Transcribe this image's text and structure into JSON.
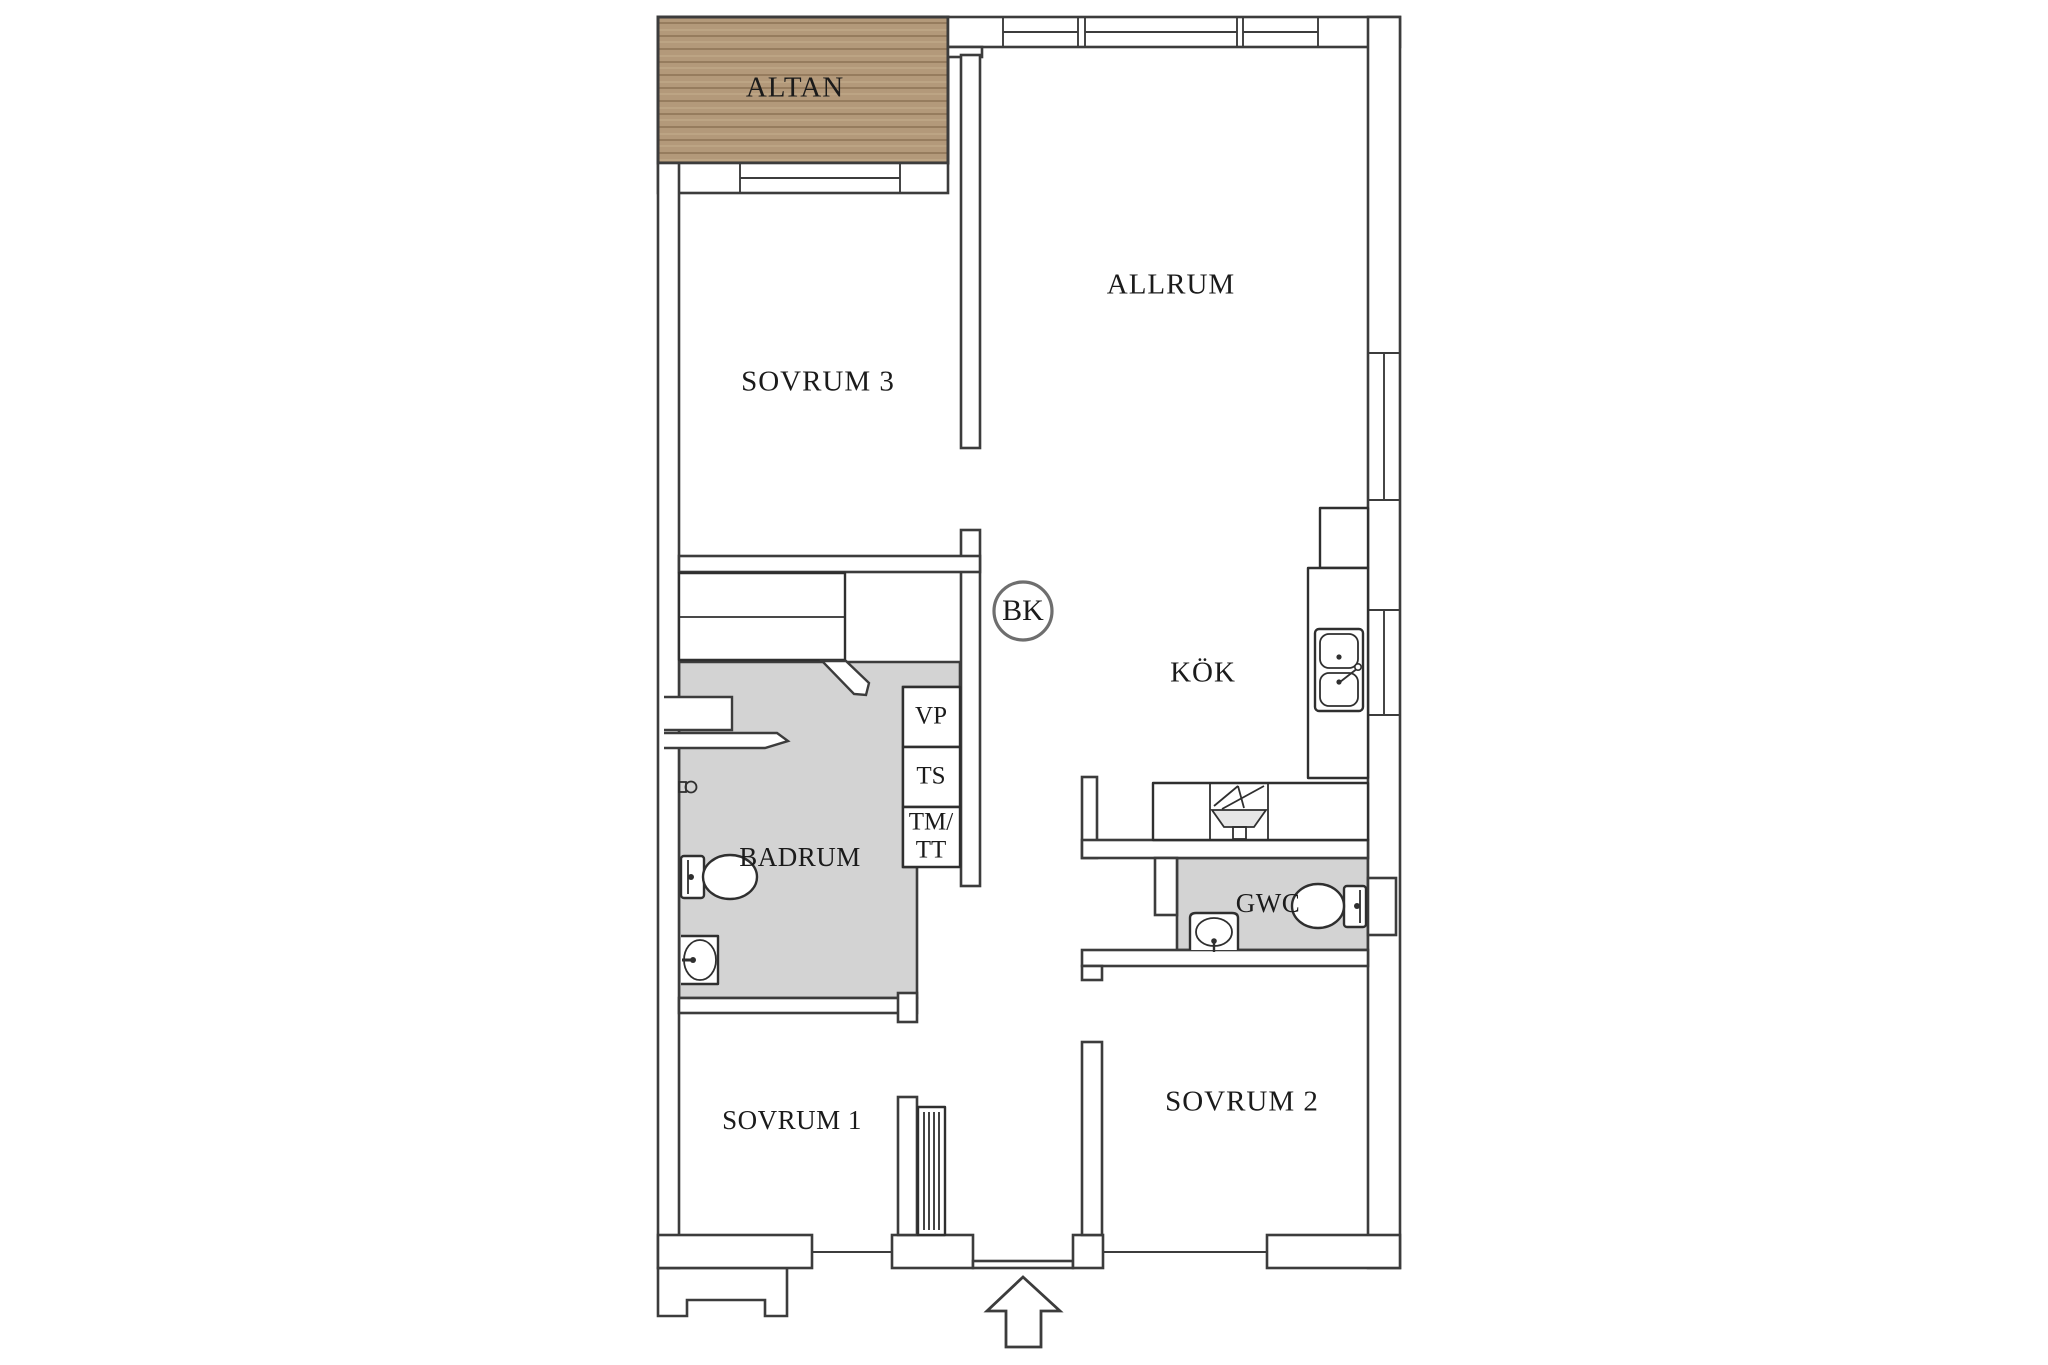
{
  "plan": {
    "rooms": {
      "altan": {
        "label": "ALTAN"
      },
      "sovrum3": {
        "label": "SOVRUM 3"
      },
      "allrum": {
        "label": "ALLRUM"
      },
      "kok": {
        "label": "KÖK"
      },
      "badrum": {
        "label": "BADRUM"
      },
      "gwc": {
        "label": "GWC"
      },
      "sovrum1": {
        "label": "SOVRUM 1"
      },
      "sovrum2": {
        "label": "SOVRUM 2"
      }
    },
    "units": {
      "vp": "VP",
      "ts": "TS",
      "tmtt_line1": "TM/",
      "tmtt_line2": "TT"
    },
    "markers": {
      "bk": "BK"
    },
    "colors": {
      "wet_room_fill": "#d3d3d3",
      "wood_base": "#b3997a",
      "wood_line": "#8d7355",
      "wood_line_light": "#c2aa8b",
      "wall_line": "#3c3c3c",
      "text": "#1b1b1b",
      "marker_circle": "#6e6e6e",
      "stove_fill": "#e6e6e6"
    }
  }
}
